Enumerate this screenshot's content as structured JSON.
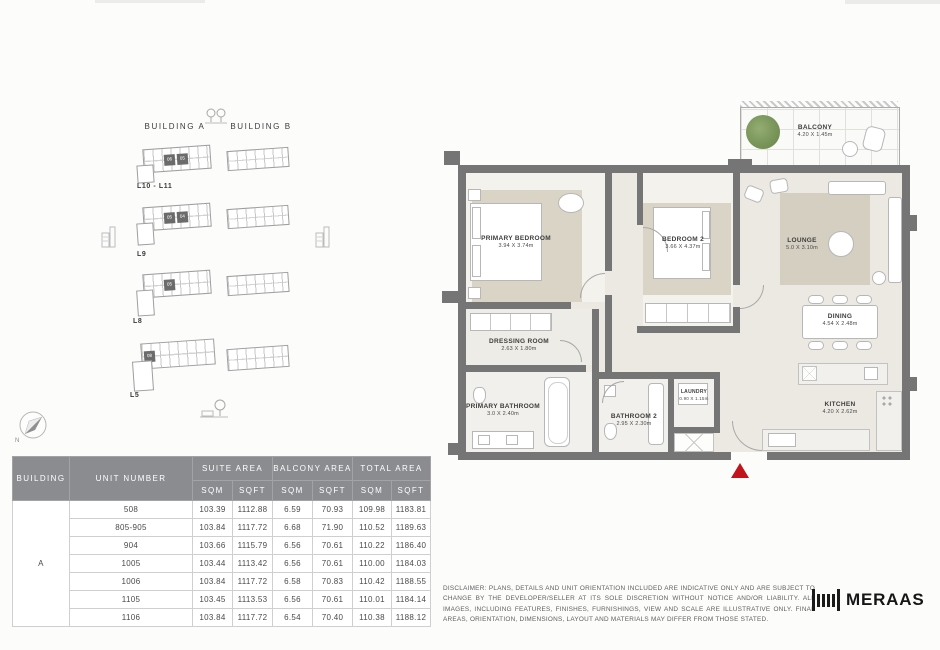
{
  "key_plan": {
    "building_a": "BUILDING A",
    "building_b": "BUILDING B",
    "compass": "N",
    "levels": [
      {
        "label": "L10 - L11",
        "units": [
          "06",
          "05"
        ]
      },
      {
        "label": "L9",
        "units": [
          "05",
          "04"
        ]
      },
      {
        "label": "L8",
        "units": [
          "05"
        ]
      },
      {
        "label": "L5",
        "units": [
          "08"
        ]
      }
    ]
  },
  "floor_plan": {
    "rooms": {
      "primary_bedroom": {
        "name": "PRIMARY BEDROOM",
        "dims": "3.94 X 3.74m"
      },
      "bedroom2": {
        "name": "BEDROOM 2",
        "dims": "3.66 X 4.37m"
      },
      "lounge": {
        "name": "LOUNGE",
        "dims": "5.0 X 3.10m"
      },
      "dining": {
        "name": "DINING",
        "dims": "4.54 X 2.48m"
      },
      "kitchen": {
        "name": "KITCHEN",
        "dims": "4.20 X 2.62m"
      },
      "dressing_room": {
        "name": "DRESSING ROOM",
        "dims": "2.63 X 1.80m"
      },
      "primary_bathroom": {
        "name": "PRIMARY BATHROOM",
        "dims": "3.0 X 2.40m"
      },
      "bathroom2": {
        "name": "BATHROOM 2",
        "dims": "2.95 X 2.30m"
      },
      "laundry": {
        "name": "LAUNDRY",
        "dims": "0.90 X 1.15m"
      },
      "balcony": {
        "name": "BALCONY",
        "dims": "4.20 X 1.45m"
      }
    }
  },
  "table": {
    "headers": {
      "building": "BUILDING",
      "unit_number": "UNIT NUMBER",
      "suite_area": "SUITE AREA",
      "balcony_area": "BALCONY AREA",
      "total_area": "TOTAL AREA",
      "sqm": "SQM",
      "sqft": "SQFT"
    },
    "building_value": "A",
    "rows": [
      [
        "508",
        "103.39",
        "1112.88",
        "6.59",
        "70.93",
        "109.98",
        "1183.81"
      ],
      [
        "805-905",
        "103.84",
        "1117.72",
        "6.68",
        "71.90",
        "110.52",
        "1189.63"
      ],
      [
        "904",
        "103.66",
        "1115.79",
        "6.56",
        "70.61",
        "110.22",
        "1186.40"
      ],
      [
        "1005",
        "103.44",
        "1113.42",
        "6.56",
        "70.61",
        "110.00",
        "1184.03"
      ],
      [
        "1006",
        "103.84",
        "1117.72",
        "6.58",
        "70.83",
        "110.42",
        "1188.55"
      ],
      [
        "1105",
        "103.45",
        "1113.53",
        "6.56",
        "70.61",
        "110.01",
        "1184.14"
      ],
      [
        "1106",
        "103.84",
        "1117.72",
        "6.54",
        "70.40",
        "110.38",
        "1188.12"
      ]
    ]
  },
  "footer": {
    "disclaimer": "DISCLAIMER: PLANS, DETAILS AND UNIT ORIENTATION INCLUDED ARE INDICATIVE ONLY AND ARE SUBJECT TO CHANGE BY THE DEVELOPER/SELLER AT ITS SOLE DISCRETION WITHOUT NOTICE AND/OR LIABILITY. ALL IMAGES, INCLUDING FEATURES, FINISHES, FURNISHINGS, VIEW AND SCALE ARE ILLUSTRATIVE ONLY. FINAL AREAS, ORIENTATION, DIMENSIONS, LAYOUT AND MATERIALS MAY DIFFER FROM THOSE STATED.",
    "brand": "MERAAS"
  },
  "colors": {
    "accent_red": "#c0151c",
    "wall_gray": "#757575",
    "header_gray": "#8b8c90"
  }
}
